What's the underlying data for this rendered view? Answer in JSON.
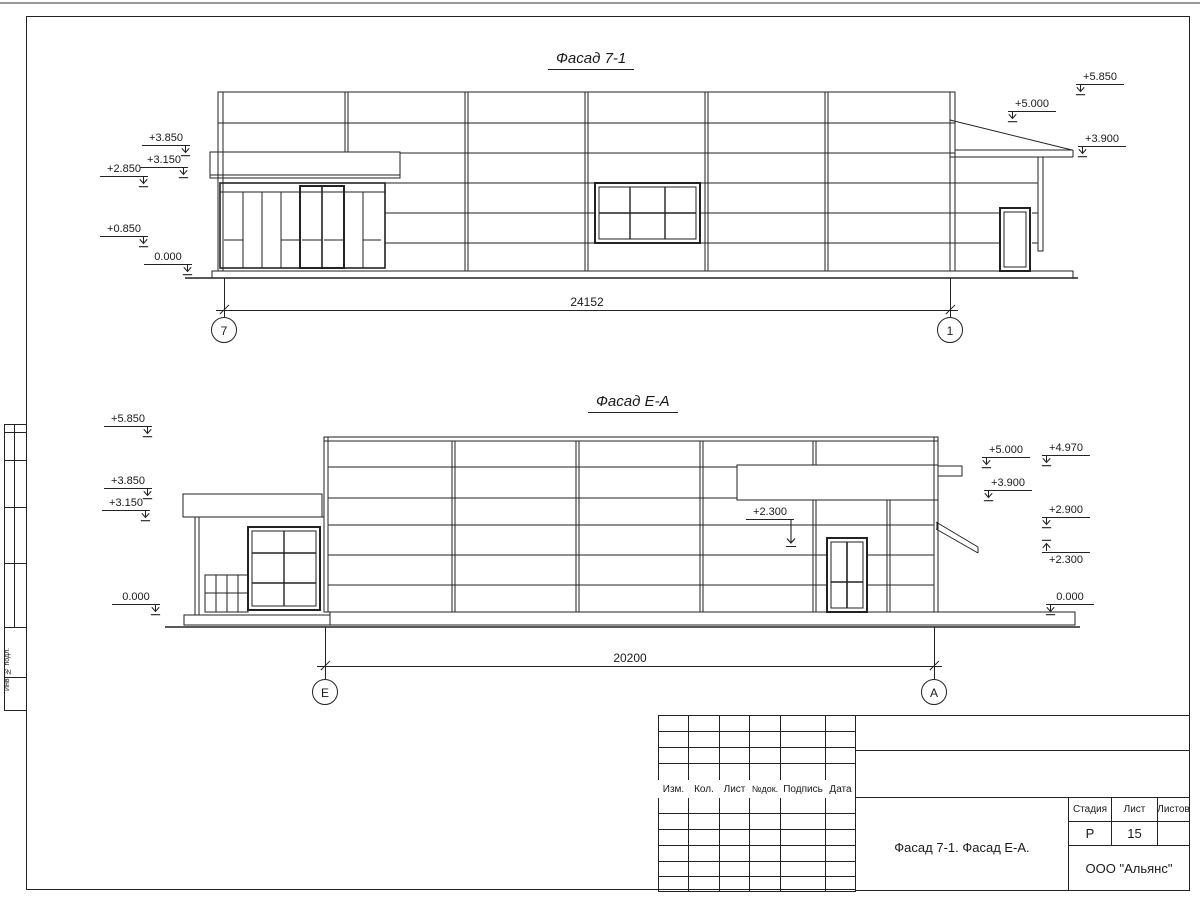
{
  "drawing1": {
    "title": "Фасад 7-1",
    "dimension": "24152",
    "axis_left": "7",
    "axis_right": "1",
    "elev_left": [
      "+3.850",
      "+3.150",
      "+2.850",
      "+0.850",
      "0.000"
    ],
    "elev_right": [
      "+5.850",
      "+5.000",
      "+3.900"
    ]
  },
  "drawing2": {
    "title": "Фасад Е-А",
    "dimension": "20200",
    "axis_left": "Е",
    "axis_right": "А",
    "elev_left": [
      "+5.850",
      "+3.850",
      "+3.150",
      "0.000"
    ],
    "elev_right1": [
      "+5.000",
      "+3.900"
    ],
    "elev_right2": [
      "+4.970",
      "+2.900",
      "+2.300",
      "0.000"
    ],
    "elev_inner": "+2.300"
  },
  "title_block": {
    "rev_headers": [
      "Изм.",
      "Кол.",
      "Лист",
      "№док.",
      "Подпись",
      "Дата"
    ],
    "stage_label": "Стадия",
    "sheet_label": "Лист",
    "sheets_label": "Листов",
    "stage_value": "Р",
    "sheet_value": "15",
    "sheets_value": "",
    "doc_title": "Фасад 7-1. Фасад Е-А.",
    "company": "ООО \"Альянс\""
  },
  "margin": {
    "label": "Инв. № подл."
  },
  "colors": {
    "ink": "#222222",
    "paper": "#ffffff"
  }
}
